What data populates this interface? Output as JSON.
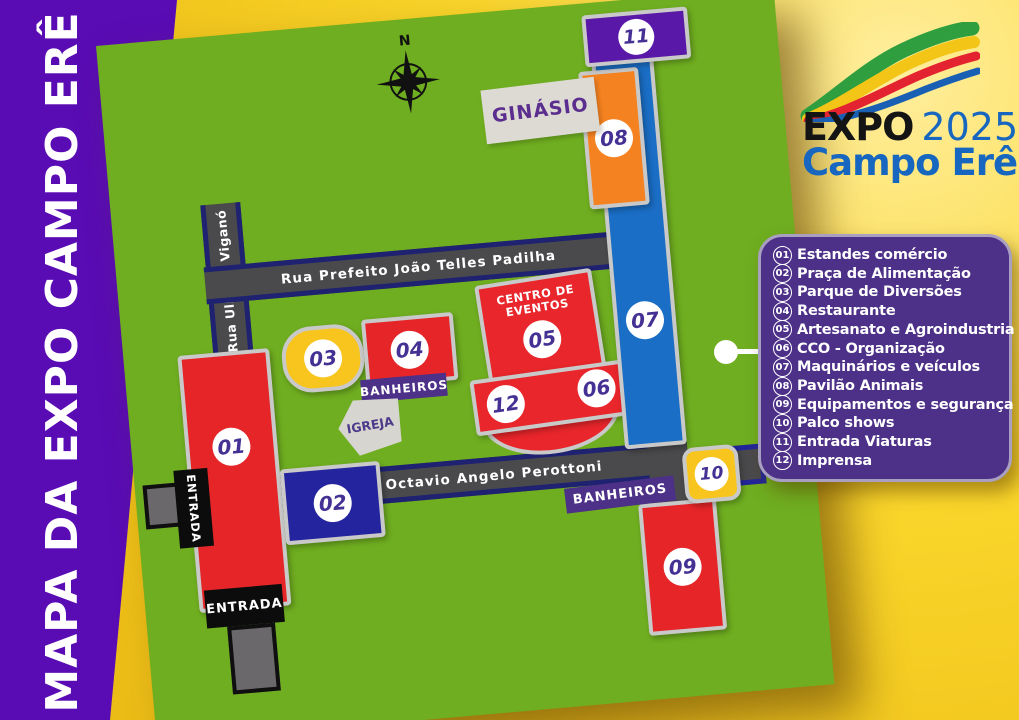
{
  "sidebar": {
    "title": "MAPA DA EXPO CAMPO ERÊ"
  },
  "logo": {
    "expo": "EXPO",
    "year": "2025",
    "city": "Campo Erê"
  },
  "map": {
    "compass_label": "N",
    "roads": {
      "padilha": "Rua Prefeito João Telles Padilha",
      "octavio": "Rua Octavio  Angelo Perottoni",
      "ulisses": "Rua Ulisses Viganó"
    },
    "labels": {
      "ginasio": "GINÁSIO",
      "igreja": "IGREJA",
      "centro_eventos_line1": "CENTRO DE",
      "centro_eventos_line2": "EVENTOS",
      "banheiros_top": "BANHEIROS",
      "banheiros_bottom": "BANHEIROS",
      "entrada_left": "ENTRADA",
      "entrada_bottom": "ENTRADA"
    },
    "blocks": [
      {
        "num": "01",
        "color": "#e52528"
      },
      {
        "num": "02",
        "color": "#24249f"
      },
      {
        "num": "03",
        "color": "#f7c51e"
      },
      {
        "num": "04",
        "color": "#e52528"
      },
      {
        "num": "05",
        "color": "#e8262b"
      },
      {
        "num": "06",
        "color": "#e8262b"
      },
      {
        "num": "07",
        "color": "#1a6ec5"
      },
      {
        "num": "08",
        "color": "#f58220"
      },
      {
        "num": "09",
        "color": "#e52528"
      },
      {
        "num": "10",
        "color": "#f7c51e"
      },
      {
        "num": "11",
        "color": "#5a18a8"
      },
      {
        "num": "12",
        "color": "#e8262b"
      }
    ]
  },
  "legend": {
    "items": [
      {
        "num": "01",
        "label": "Estandes comércio"
      },
      {
        "num": "02",
        "label": "Praça de Alimentação"
      },
      {
        "num": "03",
        "label": "Parque de Diversões"
      },
      {
        "num": "04",
        "label": "Restaurante"
      },
      {
        "num": "05",
        "label": "Artesanato e Agroindustria"
      },
      {
        "num": "06",
        "label": "CCO - Organização"
      },
      {
        "num": "07",
        "label": "Maquinários e veículos"
      },
      {
        "num": "08",
        "label": "Pavilão Animais"
      },
      {
        "num": "09",
        "label": "Equipamentos e segurança"
      },
      {
        "num": "10",
        "label": "Palco shows"
      },
      {
        "num": "11",
        "label": "Entrada Viaturas"
      },
      {
        "num": "12",
        "label": "Imprensa"
      }
    ]
  },
  "colors": {
    "map_green": "#6fae20",
    "sidebar_purple": "#5a0cb4",
    "legend_purple": "#4d3088",
    "road_gray": "#4a4a4c",
    "road_edge_navy": "#1e2270",
    "number_purple": "#453094",
    "background_yellow": "#f5cd25"
  }
}
